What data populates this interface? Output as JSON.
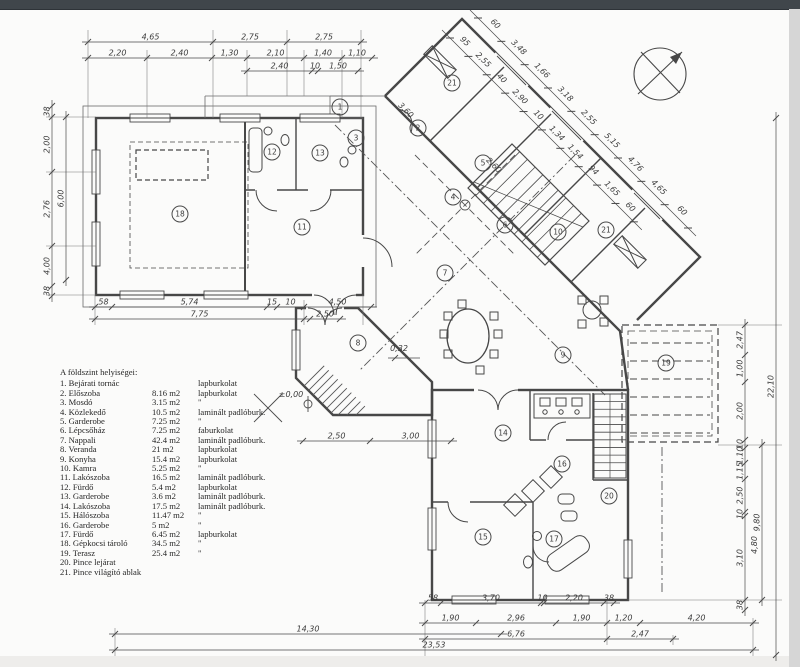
{
  "page": {
    "top_bar_color": "#40464b",
    "paper_color": "#fbfbfa",
    "ink_color": "#474747"
  },
  "legend": {
    "title": "A földszint helyiségei:",
    "rooms": [
      {
        "num": "1.",
        "name": "Bejárati tornác",
        "area": "",
        "floor": "lapburkolat"
      },
      {
        "num": "2.",
        "name": "Előszoba",
        "area": "8.16 m2",
        "floor": "lapburkolat"
      },
      {
        "num": "3.",
        "name": "Mosdó",
        "area": "3.15 m2",
        "floor": "\""
      },
      {
        "num": "4.",
        "name": "Közlekedő",
        "area": "10.5 m2",
        "floor": "laminált padlóburk."
      },
      {
        "num": "5.",
        "name": "Garderobe",
        "area": "7.25 m2",
        "floor": "\""
      },
      {
        "num": "6.",
        "name": "Lépcsőház",
        "area": "7.25 m2",
        "floor": "faburkolat"
      },
      {
        "num": "7.",
        "name": "Nappali",
        "area": "42.4 m2",
        "floor": "laminált padlóburk."
      },
      {
        "num": "8.",
        "name": "Veranda",
        "area": "21 m2",
        "floor": "lapburkolat"
      },
      {
        "num": "9.",
        "name": "Konyha",
        "area": "15.4 m2",
        "floor": "lapburkolat"
      },
      {
        "num": "10.",
        "name": "Kamra",
        "area": "5.25 m2",
        "floor": "\""
      },
      {
        "num": "11.",
        "name": "Lakószoba",
        "area": "16.5 m2",
        "floor": "laminált padlóburk."
      },
      {
        "num": "12.",
        "name": "Fürdő",
        "area": "5.4 m2",
        "floor": "lapburkolat"
      },
      {
        "num": "13.",
        "name": "Garderobe",
        "area": "3.6 m2",
        "floor": "laminált padlóburk."
      },
      {
        "num": "14.",
        "name": "Lakószoba",
        "area": "17.5 m2",
        "floor": "laminált padlóburk."
      },
      {
        "num": "15.",
        "name": "Hálószoba",
        "area": "11.47 m2",
        "floor": "\""
      },
      {
        "num": "16.",
        "name": "Garderobe",
        "area": "5 m2",
        "floor": "\""
      },
      {
        "num": "17.",
        "name": "Fürdő",
        "area": "6.45 m2",
        "floor": "lapburkolat"
      },
      {
        "num": "18.",
        "name": "Gépkocsi tároló",
        "area": "34.5 m2",
        "floor": "\""
      },
      {
        "num": "19.",
        "name": "Terasz",
        "area": "25.4 m2",
        "floor": "\""
      },
      {
        "num": "20.",
        "name": "Pince lejárat",
        "area": "",
        "floor": ""
      },
      {
        "num": "21.",
        "name": "Pince világító ablak",
        "area": "",
        "floor": ""
      }
    ]
  },
  "plan": {
    "room_markers": [
      {
        "label": "1",
        "x": 340,
        "y": 107
      },
      {
        "label": "2",
        "x": 418,
        "y": 128
      },
      {
        "label": "3",
        "x": 356,
        "y": 138
      },
      {
        "label": "4",
        "x": 453,
        "y": 197
      },
      {
        "label": "5",
        "x": 483,
        "y": 163
      },
      {
        "label": "6",
        "x": 505,
        "y": 225
      },
      {
        "label": "7",
        "x": 445,
        "y": 273
      },
      {
        "label": "8",
        "x": 358,
        "y": 343
      },
      {
        "label": "9",
        "x": 563,
        "y": 355
      },
      {
        "label": "10",
        "x": 558,
        "y": 232
      },
      {
        "label": "21",
        "x": 606,
        "y": 230
      },
      {
        "label": "21",
        "x": 452,
        "y": 83
      },
      {
        "label": "11",
        "x": 302,
        "y": 227
      },
      {
        "label": "12",
        "x": 272,
        "y": 152
      },
      {
        "label": "13",
        "x": 320,
        "y": 153
      },
      {
        "label": "14",
        "x": 503,
        "y": 433
      },
      {
        "label": "15",
        "x": 483,
        "y": 537
      },
      {
        "label": "16",
        "x": 562,
        "y": 464
      },
      {
        "label": "17",
        "x": 554,
        "y": 539
      },
      {
        "label": "18",
        "x": 180,
        "y": 214
      },
      {
        "label": "19",
        "x": 666,
        "y": 363
      },
      {
        "label": "20",
        "x": 609,
        "y": 496
      }
    ],
    "chains": [
      {
        "dir": "h",
        "pos": 42,
        "ticks": [
          88,
          213,
          287,
          361
        ],
        "labels": [
          "4,65",
          "2,75",
          "2,75"
        ]
      },
      {
        "dir": "h",
        "pos": 58,
        "ticks": [
          88,
          147,
          212,
          247,
          304,
          342,
          372
        ],
        "labels": [
          "2,20",
          "2,40",
          "1,30",
          "2,10",
          "1,40",
          "1,10"
        ]
      },
      {
        "dir": "h",
        "pos": 71,
        "ticks": [
          247,
          312,
          318,
          358
        ],
        "labels": [
          "2,40",
          "10",
          "1,50"
        ]
      },
      {
        "dir": "v",
        "pos": 52,
        "ticks": [
          106,
          117,
          172,
          246,
          286,
          296
        ],
        "labels": [
          "38",
          "2,00",
          "2,76",
          "4,00",
          "38"
        ]
      },
      {
        "dir": "v",
        "pos": 66,
        "ticks": [
          117,
          280
        ],
        "labels": [
          "6,00"
        ]
      },
      {
        "dir": "h",
        "pos": 307,
        "ticks": [
          95,
          112,
          267,
          277,
          304,
          371
        ],
        "labels": [
          "58",
          "5,74",
          "15",
          "10",
          "4,50"
        ]
      },
      {
        "dir": "h",
        "pos": 319,
        "ticks": [
          95,
          304,
          310,
          340
        ],
        "labels": [
          "7,75",
          "",
          "2,50"
        ]
      },
      {
        "dir": "h",
        "pos": 441,
        "ticks": [
          303,
          370,
          451
        ],
        "labels": [
          "2,50",
          "3,00"
        ]
      },
      {
        "dir": "h",
        "pos": 603,
        "ticks": [
          425,
          441,
          541,
          544,
          604,
          614
        ],
        "labels": [
          "58",
          "3,70",
          "10",
          "2,20",
          "38"
        ]
      },
      {
        "dir": "h",
        "pos": 623,
        "ticks": [
          425,
          476,
          556,
          607,
          640,
          753
        ],
        "labels": [
          "1,90",
          "2,96",
          "1,90",
          "1,20",
          "4,20"
        ]
      },
      {
        "dir": "h",
        "pos": 639,
        "ticks": [
          425,
          607,
          673
        ],
        "labels": [
          "6,76",
          "2,47"
        ]
      },
      {
        "dir": "h",
        "pos": 634,
        "ticks": [
          115,
          501
        ],
        "labels": [
          "14,30"
        ]
      },
      {
        "dir": "h",
        "pos": 650,
        "ticks": [
          115,
          753
        ],
        "labels": [
          "23,53"
        ]
      },
      {
        "dir": "v",
        "pos": 745,
        "ticks": [
          325,
          355,
          382,
          440,
          448,
          463,
          479,
          512,
          516,
          600,
          610
        ],
        "labels": [
          "2,47",
          "1,00",
          "2,00",
          "10",
          "1,10",
          "1,15",
          "2,50",
          "10",
          "3,10",
          "38"
        ]
      },
      {
        "dir": "v",
        "pos": 762,
        "ticks": [
          445,
          600
        ],
        "labels": [
          "9,80"
        ]
      },
      {
        "dir": "v",
        "pos": 776,
        "ticks": [
          118,
          655
        ],
        "labels": [
          "22,10"
        ]
      }
    ],
    "diag_chains": [
      {
        "start": [
          450,
          38
        ],
        "step": 26,
        "labels": [
          "95",
          "2,55",
          "40",
          "2,90",
          "10",
          "1,34",
          "1,54",
          "94",
          "1,65",
          "60"
        ]
      },
      {
        "start": [
          478,
          18
        ],
        "step": 33,
        "labels": [
          "60",
          "3,48",
          "1,66",
          "3,18",
          "2,55",
          "5,15",
          "4,76",
          "4,65",
          "60"
        ]
      }
    ],
    "free_labels": [
      {
        "t": "3,60",
        "x": 404,
        "y": 112,
        "r": 45
      },
      {
        "t": "2,60",
        "x": 492,
        "y": 167,
        "r": 45
      },
      {
        "t": "0,32",
        "x": 399,
        "y": 351,
        "r": 0
      },
      {
        "t": "±0,00",
        "x": 291,
        "y": 397,
        "r": 0
      },
      {
        "t": "4,80",
        "x": 757,
        "y": 545,
        "r": -90
      }
    ],
    "stairs": [
      {
        "type": "diag",
        "a": [
          468,
          188
        ],
        "b": [
          512,
          144
        ],
        "c": [
          589,
          221
        ],
        "d": [
          545,
          265
        ],
        "n": 10
      },
      {
        "type": "rect",
        "x": 594,
        "y": 394,
        "w": 32,
        "h": 84,
        "n": 11
      }
    ],
    "north_arrow": {
      "cx": 660,
      "cy": 74,
      "r": 26
    }
  }
}
